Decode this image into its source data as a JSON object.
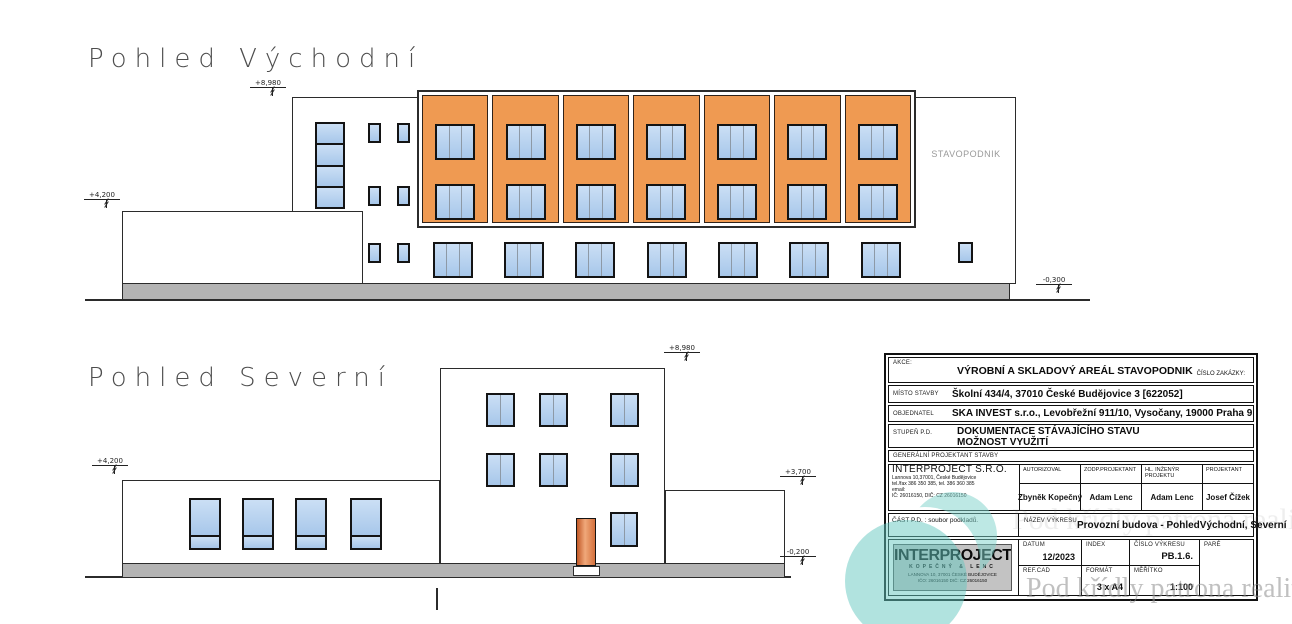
{
  "east_view": {
    "title": "Pohled Východní",
    "building_label": "STAVOPODNIK",
    "levels": {
      "roof": "+8,980",
      "annex": "+4,200",
      "base": "-0,300"
    },
    "facade": {
      "bays": 7,
      "small_window_rows": 3,
      "small_window_cols": 2,
      "ground_windows": 7
    }
  },
  "north_view": {
    "title": "Pohled Severní",
    "levels": {
      "roof": "+8,980",
      "annex_left": "+4,200",
      "annex_right": "+3,700",
      "base": "-0,200"
    },
    "left_windows": 4,
    "upper_window_cols": 3,
    "upper_window_rows": 2
  },
  "title_block": {
    "akce_label": "AKCE:",
    "akce_value": "VÝROBNÍ A SKLADOVÝ AREÁL STAVOPODNIK",
    "cislo_zakazky_label": "ČÍSLO ZAKÁZKY:",
    "misto_label": "MÍSTO STAVBY",
    "misto_value": "Školní 434/4, 37010 České Budějovice 3 [622052]",
    "objednatel_label": "OBJEDNATEL",
    "objednatel_value": "SKA INVEST s.r.o., Levobřežní 911/10, Vysočany, 19000 Praha 9",
    "stupen_label": "STUPEŇ P.D.",
    "stupen_value_1": "DOKUMENTACE STÁVAJÍCÍHO STAVU",
    "stupen_value_2": "MOŽNOST VYUŽITÍ",
    "gen_projektant_label": "GENERÁLNÍ PROJEKTANT STAVBY",
    "firm_name": "INTERPROJECT S.R.O.",
    "firm_addr_1": "Lannova 10,37001, České Budějovice",
    "firm_addr_2": "tel./fax 386 350 385, tel. 386 360 385",
    "firm_addr_3": "email:",
    "firm_addr_4": "IČ: 26016150, DIČ: CZ 26016150",
    "autorizoval_label": "AUTORIZOVAL",
    "autorizoval_value": "Zbyněk Kopečný",
    "zodp_label": "ZODP.PROJEKTANT",
    "zodp_value": "Adam Lenc",
    "hl_inzenyr_label": "HL. INŽENÝR PROJEKTU",
    "hl_inzenyr_value": "Adam Lenc",
    "projektant_label": "PROJEKTANT",
    "projektant_value": "Josef Čížek",
    "cast_pd_label": "ČÁST P.D. : soubor podkladů.",
    "nazev_label": "NÁZEV VÝKRESU",
    "nazev_value": "Provozní budova - PohledVýchodní, Severní",
    "logo_name": "INTERPROJECT",
    "logo_sub": "KOPEČNÝ & LENC",
    "logo_addr_1": "LANNOVA 10, 37001 ČESKÉ BUDĚJOVICE",
    "logo_addr_2": "IČO: 26016150   DIČ: CZ 26016150",
    "datum_label": "DATUM",
    "datum_value": "12/2023",
    "index_label": "INDEX",
    "index_value": "",
    "cislo_vykresu_label": "ČÍSLO VÝKRESU",
    "cislo_vykresu_value": "PB.1.6.",
    "pare_label": "PARÉ",
    "refcad_label": "REF.CAD",
    "refcad_value": "",
    "format_label": "FORMÁT",
    "format_value": "3 x A4",
    "meritko_label": "MĚŘÍTKO",
    "meritko_value": "1:100"
  },
  "watermark": {
    "text": "Pod křídly patrona realit"
  },
  "colors": {
    "facade_orange": "#ef9a52",
    "window_blue": "#aecbea",
    "plinth_gray": "#b3b3b3",
    "door_terracotta": "#d4703c",
    "teal_logo": "#6cc9c1"
  }
}
